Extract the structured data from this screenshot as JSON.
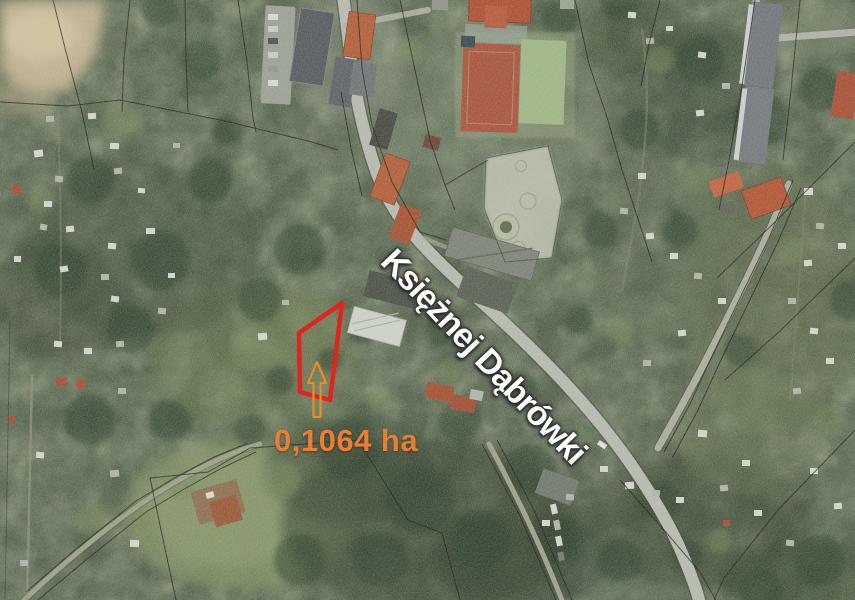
{
  "labels": {
    "street": "Księżnej Dąbrówki",
    "area": "0,1064 ha"
  },
  "colors": {
    "parcel_outline": "#e3231d",
    "arrow": "#e78e28",
    "area_text": "#ed7d31",
    "street_text": "#ffffff",
    "street_text_shadow": "#2e2e2e",
    "boundary_line": "#161613"
  }
}
